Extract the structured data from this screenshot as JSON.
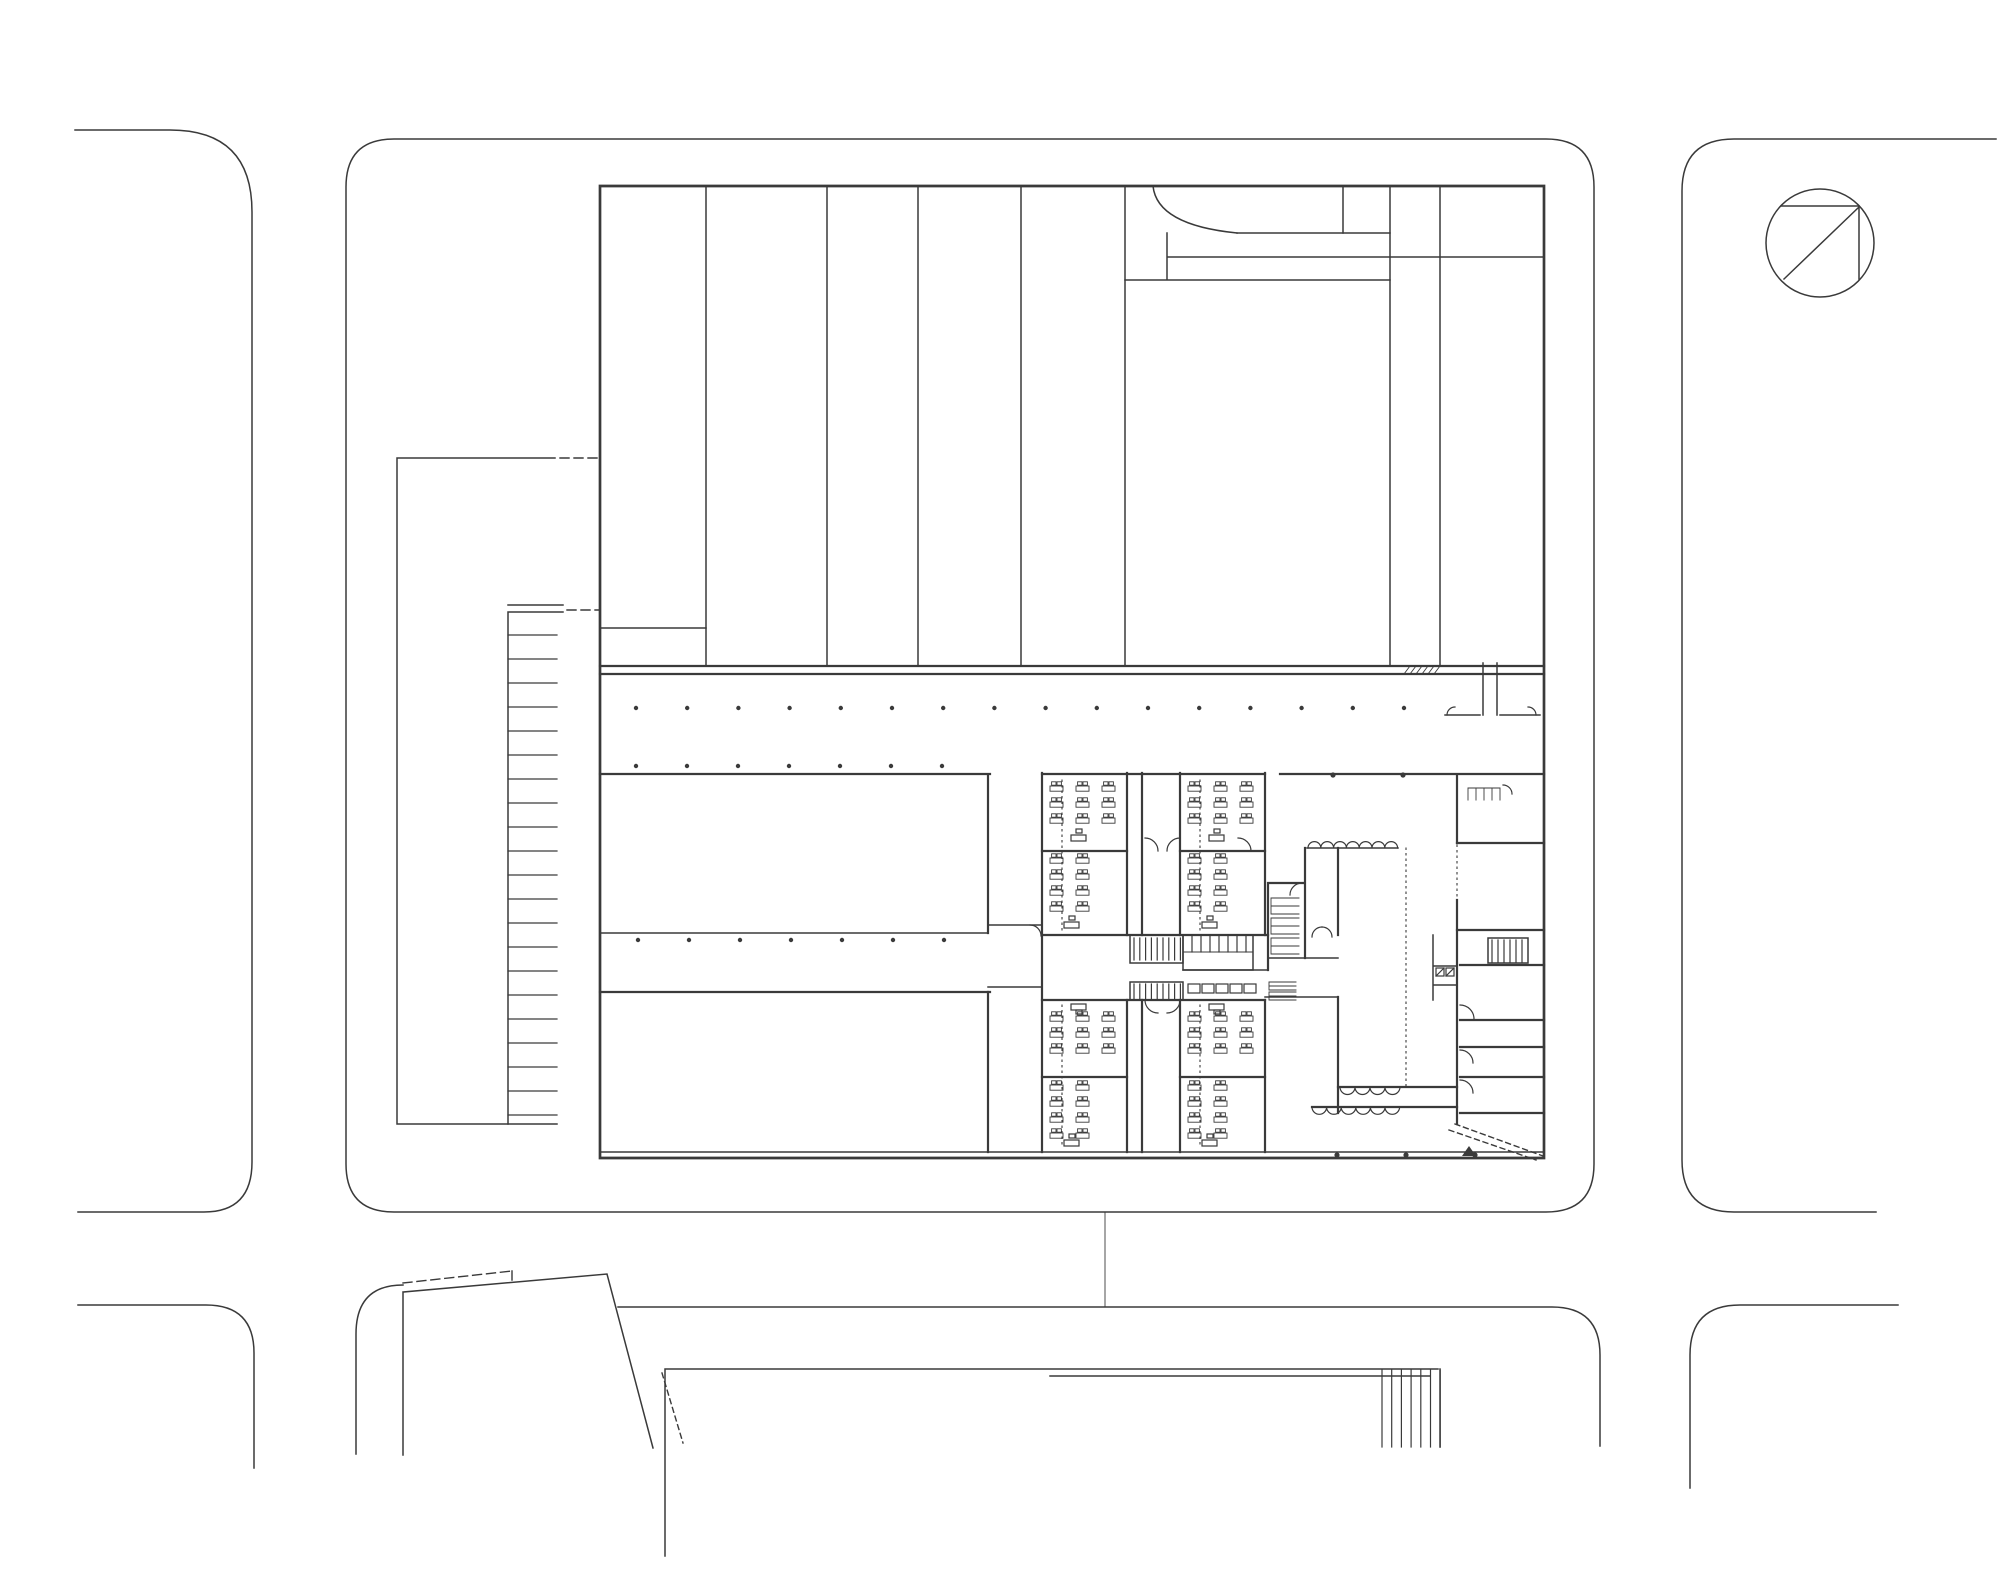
{
  "plan": {
    "drawing_type": "architectural ground-floor site plan (black line work on white paper, no text labels)",
    "visible_text": [],
    "ink_color": "#3a3a3a",
    "paper_color": "#ffffff",
    "symbols": {
      "north_arrow": "circle with top chord, right chord and diagonal",
      "parking_stall_count": 21,
      "classroom_count": 8,
      "column_grid": "rows of small dots",
      "stairs": "dense parallel hatch lines"
    }
  },
  "repeats": [
    {
      "target": "dots-row-1",
      "type": "dots",
      "x0": 636,
      "step": 51.2,
      "count": 16,
      "y": 708,
      "r": 2.2
    },
    {
      "target": "dots-row-2",
      "type": "dots",
      "x0": 636,
      "step": 51,
      "count": 7,
      "y": 766,
      "r": 2.2
    },
    {
      "target": "dots-row-3",
      "type": "dots",
      "x0": 638,
      "step": 51,
      "count": 7,
      "y": 940,
      "r": 2.2
    },
    {
      "target": "wall-dots",
      "type": "dots",
      "x0": 1333,
      "step": 70,
      "count": 2,
      "y": 775,
      "r": 2.6
    },
    {
      "target": "edge-dots",
      "type": "dots",
      "x0": 1337,
      "step": 69,
      "count": 3,
      "y": 1155,
      "r": 2.6
    },
    {
      "target": "parking-rungs",
      "type": "hlines",
      "x1": 508,
      "x2": 557,
      "y0": 635,
      "step": 24,
      "count": 21
    },
    {
      "target": "stair-a-hatch",
      "type": "vlines",
      "x0": 1134,
      "step": 5.8,
      "count": 9,
      "y1": 938,
      "y2": 960
    },
    {
      "target": "locker-hatch",
      "type": "vlines",
      "x0": 1134,
      "step": 5.8,
      "count": 9,
      "y1": 984,
      "y2": 999
    },
    {
      "target": "toilet-stalls",
      "type": "vlines",
      "x0": 1192,
      "step": 9,
      "count": 7,
      "y1": 935,
      "y2": 952
    },
    {
      "target": "stair-b-hatch",
      "type": "vlines",
      "x0": 1492,
      "step": 6,
      "count": 6,
      "y1": 940,
      "y2": 962
    },
    {
      "target": "south-stair-hatch",
      "type": "vlines",
      "x0": 1382,
      "step": 9.7,
      "count": 7,
      "y1": 1370,
      "y2": 1447
    },
    {
      "target": "band-hatch",
      "type": "dlines",
      "x0": 1404,
      "step": 6,
      "count": 6,
      "y1": 666,
      "y2": 674,
      "dx": 6
    },
    {
      "target": "scallops-1",
      "type": "scallops",
      "x0": 1308,
      "y": 848,
      "r": 6.4,
      "count": 7,
      "flip": false
    },
    {
      "target": "scallops-2",
      "type": "scallops",
      "x0": 1340,
      "y": 1087,
      "r": 7.5,
      "count": 4,
      "flip": true
    },
    {
      "target": "scallops-3",
      "type": "scallops",
      "x0": 1312,
      "y": 1107,
      "r": 7.3,
      "count": 6,
      "flip": true
    },
    {
      "target": "combs-left",
      "type": "combs",
      "x": 1271,
      "y0": 898,
      "w": 28,
      "h": 16,
      "count": 3,
      "gap": 4
    },
    {
      "target": "combs-b",
      "type": "combs",
      "x": 1269,
      "y0": 982,
      "w": 27,
      "h": 8,
      "count": 2,
      "gap": 2
    },
    {
      "target": "combs-top-right",
      "type": "combsh",
      "x0": 1468,
      "y": 788,
      "tooth": 12,
      "step": 8,
      "count": 5
    },
    {
      "target": "locker-row",
      "type": "rectrow",
      "x0": 1188,
      "y": 984,
      "w": 12,
      "h": 9,
      "step": 14,
      "count": 5
    },
    {
      "target": "desks-1a",
      "type": "deskgrid",
      "x0": 1050,
      "y0": 786,
      "cols": 3,
      "rows": 3,
      "dx": 26,
      "dy": 16
    },
    {
      "target": "desks-2a",
      "type": "deskgrid",
      "x0": 1188,
      "y0": 786,
      "cols": 3,
      "rows": 3,
      "dx": 26,
      "dy": 16
    },
    {
      "target": "desks-1b",
      "type": "deskgrid",
      "x0": 1050,
      "y0": 858,
      "cols": 2,
      "rows": 4,
      "dx": 26,
      "dy": 16
    },
    {
      "target": "desks-2b",
      "type": "deskgrid",
      "x0": 1188,
      "y0": 858,
      "cols": 2,
      "rows": 4,
      "dx": 26,
      "dy": 16
    },
    {
      "target": "desks-1c",
      "type": "deskgrid",
      "x0": 1050,
      "y0": 1016,
      "cols": 3,
      "rows": 3,
      "dx": 26,
      "dy": 16
    },
    {
      "target": "desks-2c",
      "type": "deskgrid",
      "x0": 1188,
      "y0": 1016,
      "cols": 3,
      "rows": 3,
      "dx": 26,
      "dy": 16
    },
    {
      "target": "desks-1d",
      "type": "deskgrid",
      "x0": 1050,
      "y0": 1085,
      "cols": 2,
      "rows": 4,
      "dx": 26,
      "dy": 16
    },
    {
      "target": "desks-2d",
      "type": "deskgrid",
      "x0": 1188,
      "y0": 1085,
      "cols": 2,
      "rows": 4,
      "dx": 26,
      "dy": 16
    }
  ]
}
